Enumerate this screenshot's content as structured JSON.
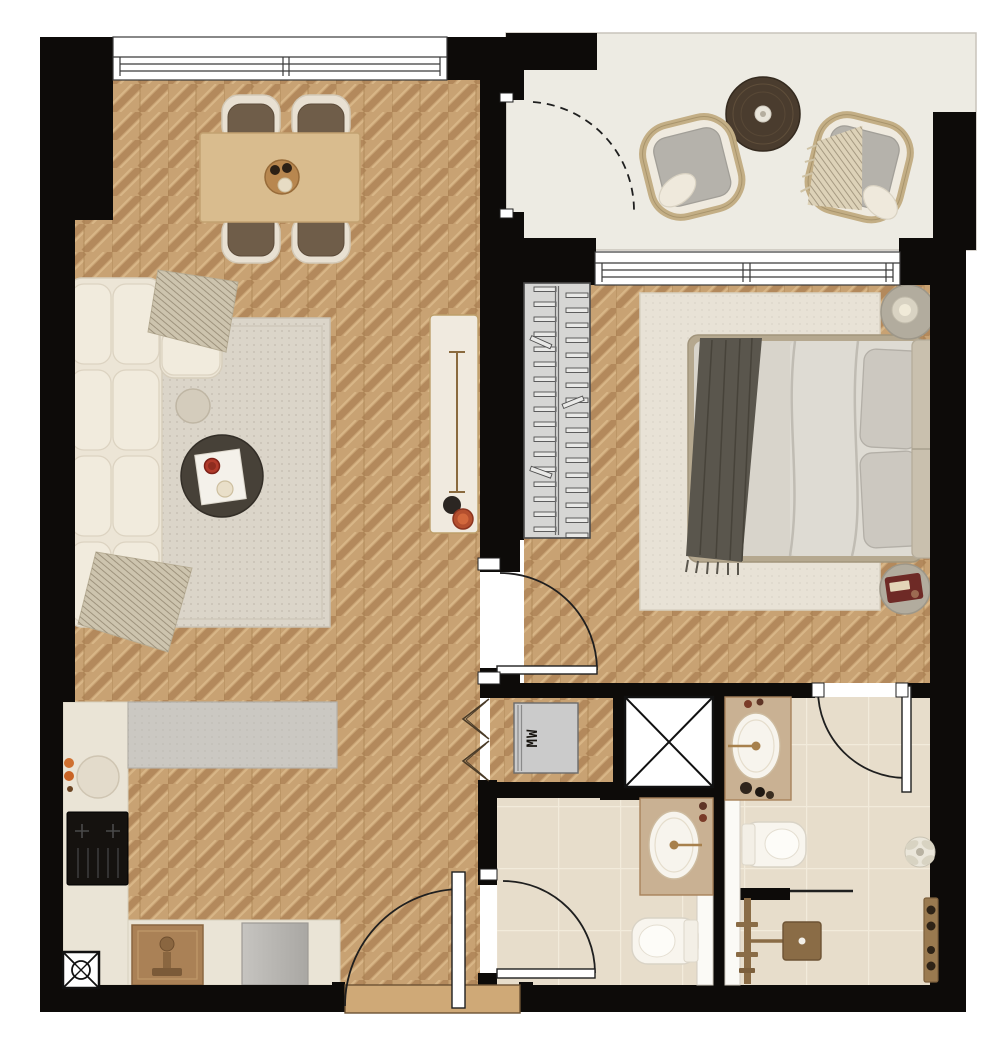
{
  "floor_plan": {
    "appliance_label": "MW",
    "rooms": [
      "living-dining-room",
      "open-kitchen",
      "entry",
      "balcony",
      "bedroom",
      "wardrobe-closet",
      "hallway",
      "guest-bathroom",
      "ensuite-shower-room",
      "utility-niche",
      "ventilation-shaft"
    ],
    "furniture": [
      "sectional-sofa",
      "area-rug",
      "coffee-table",
      "side-table",
      "dining-table",
      "dining-chairs",
      "console-table",
      "kitchen-counter",
      "induction-cooktop",
      "kitchen-sink",
      "dishwasher",
      "double-bed",
      "nightstands",
      "bedroom-rug",
      "wardrobe-rail",
      "washer-appliance",
      "balcony-lounge-chairs",
      "balcony-table",
      "vanity-sinks",
      "toilets",
      "walk-in-shower",
      "plant"
    ],
    "colors": {
      "wall": "#0d0b09",
      "wood_base": "#c8a273",
      "wood_dark": "#b3895c",
      "wood_light": "#d8b687",
      "stone": "#edebe3",
      "tile": "#e7ddcb",
      "grout": "#f2ebdb",
      "counter_stone": "#cbc8c2",
      "counter_cream": "#eae4d6",
      "cabinet_tan": "#c9b193",
      "brass": "#a7804c",
      "fixture_bronze": "#8a6c46",
      "white_fixture": "#f8f5ee",
      "sofa_cream": "#ece5d6",
      "rug_beige": "#dbd5c9",
      "table_oak": "#d9bc8e",
      "coffee_table_dark": "#474138",
      "accent_red": "#b03a2a",
      "appliance_gray": "#cbcbcb",
      "bed_duvet": "#d8d4cb",
      "throw_charcoal": "#5a564d",
      "wardrobe_gray": "#d6d6d4"
    }
  }
}
